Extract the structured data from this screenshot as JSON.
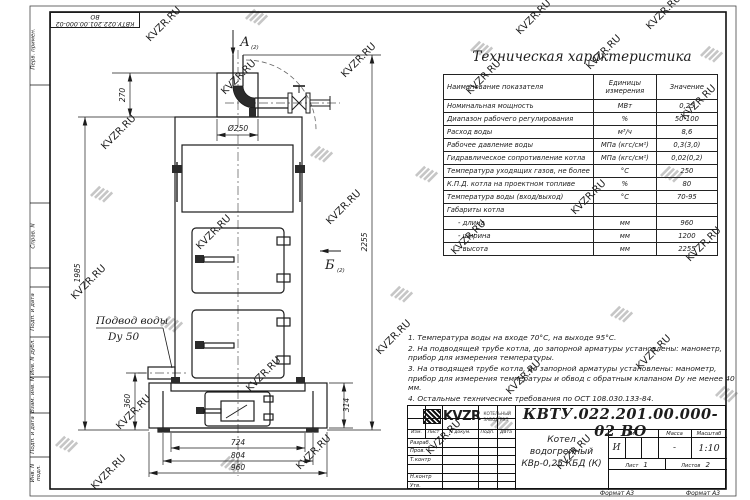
{
  "doc_number": "КВТУ.022.201.00.000-02  ВО",
  "watermark_text": "KVZR.RU",
  "margin_labels": [
    "Перв. примен.",
    "Справ. N",
    "Подп. и дата",
    "Инв. N дубл.",
    "Взам. инв. N",
    "Подп. и дата",
    "Инв. N подл."
  ],
  "spec_table": {
    "title": "Техническая характеристика",
    "col_headers": [
      "Наименование показателя",
      "Единицы измерения",
      "Значение"
    ],
    "rows": [
      [
        "Номинальная мощность",
        "МВт",
        "0,25"
      ],
      [
        "Диапазон рабочего регулирования",
        "%",
        "50-100"
      ],
      [
        "Расход воды",
        "м³/ч",
        "8,6"
      ],
      [
        "Рабочее давление воды",
        "МПа (кгс/см²)",
        "0,3(3,0)"
      ],
      [
        "Гидравлическое сопротивление котла",
        "МПа (кгс/см²)",
        "0,02(0,2)"
      ],
      [
        "Температура уходящих газов, не более",
        "°С",
        "250"
      ],
      [
        "К.П.Д. котла на проектном топливе",
        "%",
        "80"
      ],
      [
        "Температура воды (вход/выход)",
        "°С",
        "70-95"
      ],
      [
        "Габариты котла",
        "",
        ""
      ],
      [
        "- длина",
        "мм",
        "960"
      ],
      [
        "- ширина",
        "мм",
        "1200"
      ],
      [
        "- высота",
        "мм",
        "2255"
      ]
    ]
  },
  "notes": [
    "1.  Температура воды на входе  70°С, на выходе  95°С.",
    "2.  На подводящей трубе котла, до запорной арматуры установлены:  манометр, прибор для измерения температуры.",
    "3.  На отводящей трубе котла, до запорной арматуры установлены:  манометр, прибор для измерения температуры и обвод с обратным клапаном  Dу не менее 40 мм.",
    "4.  Остальные технические требования по ОСТ  108.030.133-84."
  ],
  "drawing": {
    "view_a": "А",
    "view_a_index": "(2)",
    "view_b": "Б",
    "view_b_index": "(2)",
    "inlet_line1": "Подвод воды",
    "inlet_line2": "Dу 50",
    "dims": {
      "top_offset": "270",
      "chimney_dia": "Ø250",
      "body_height": "1985",
      "total_height": "2255",
      "inlet_height": "360",
      "base_height": "314",
      "width_inner": "724",
      "width_mid": "804",
      "width_outer": "960"
    }
  },
  "title_block": {
    "col_izm": "Изм.",
    "col_list": "Лист",
    "col_docnum": "N докум.",
    "col_podp": "Подп.",
    "col_data": "Дата",
    "row_razrab": "Разраб.",
    "row_prov": "Пров.",
    "row_tkontr": "Т.контр",
    "row_nkontr": "Н.контр",
    "row_utv": "Утв.",
    "product_name_1": "Котел водогрейный",
    "product_name_2": "КВр-0,25  КБД  (К)",
    "lit_label": "Лит.",
    "lit_value": "И",
    "massa_label": "Масса",
    "massa_value": "-",
    "scale_label": "Масштаб",
    "scale_value": "1:10",
    "sheet_label": "Лист",
    "sheet_value": "1",
    "sheets_label": "Листов",
    "sheets_value": "2",
    "logo_text": "KVZR",
    "logo_sub1": "КОТЕЛЬНЫЙ",
    "logo_sub2": "ЗАВОД РЭП",
    "format_note": "Формат А3"
  }
}
